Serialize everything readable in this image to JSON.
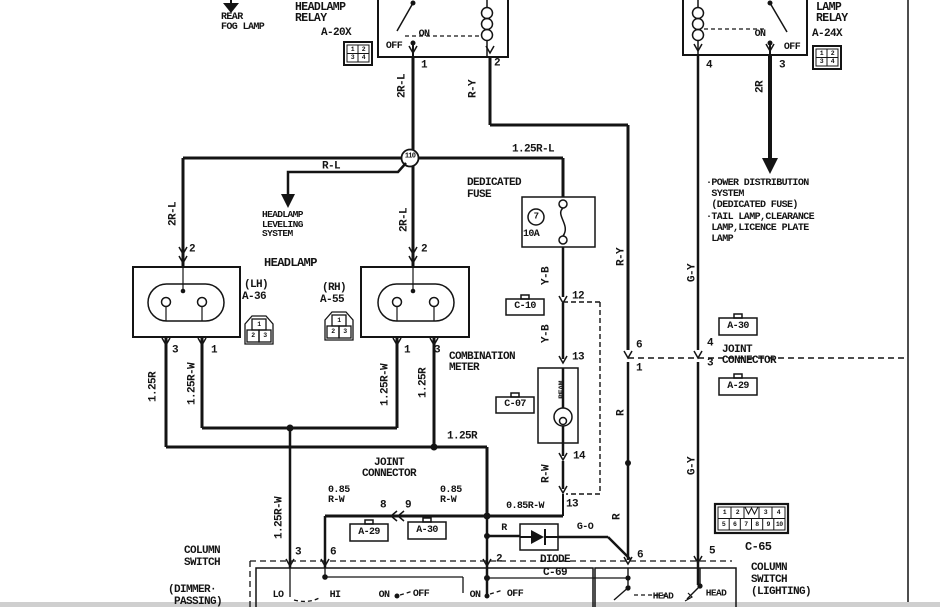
{
  "ink": "#141414",
  "page": {
    "right_border": true,
    "bottom_strip_color": "#cfcfcf"
  },
  "arrows_text": {
    "rear_fog": "REAR\nFOG LAMP",
    "leveling": "HEADLAMP\nLEVELING\nSYSTEM",
    "notes": "·POWER DISTRIBUTION\n SYSTEM\n (DEDICATED FUSE)\n·TAIL LAMP,CLEARANCE\n LAMP,LICENCE PLATE\n LAMP"
  },
  "relays": {
    "headlamp": {
      "name": "HEADLAMP\nRELAY",
      "code": "A-20X",
      "on": "ON",
      "off": "OFF",
      "pin_left": "1",
      "pin_right": "2"
    },
    "tail": {
      "name": "LAMP\nRELAY",
      "code": "A-24X",
      "on": "ON",
      "off": "OFF",
      "pin_left": "4",
      "pin_right": "3"
    }
  },
  "grid_pins": [
    "1",
    "2",
    "3",
    "4"
  ],
  "splice": "110",
  "fuse": {
    "title": "DEDICATED\nFUSE",
    "number": "7",
    "rating": "10A"
  },
  "headlamps": {
    "title": "HEADLAMP",
    "lh": "(LH)",
    "lh_code": "A-36",
    "rh": "(RH)",
    "rh_code": "A-55",
    "lh_top": "2",
    "lh_b1": "3",
    "lh_b2": "1",
    "rh_top": "2",
    "rh_b1": "1",
    "rh_b2": "3",
    "conn_pins": [
      "1",
      "2",
      "3"
    ]
  },
  "meter": {
    "title": "COMBINATION\nMETER",
    "beam": "BEAM",
    "c10": "C-10",
    "c07": "C-07",
    "pin12": "12",
    "pin13": "13",
    "pin14": "14",
    "pin13b": "13"
  },
  "joint_mid": {
    "title": "JOINT\nCONNECTOR",
    "a29": "A-29",
    "a30": "A-30",
    "pin8": "8",
    "pin9": "9",
    "w_left": "0.85\nR-W",
    "w_right": "0.85\nR-W",
    "w_out": "0.85R-W"
  },
  "joint_right": {
    "title": "JOINT\nCONNECTOR",
    "a30": "A-30",
    "a29": "A-29",
    "pin6": "6",
    "pin1": "1",
    "pin4": "4",
    "pin3": "3"
  },
  "diode": {
    "title": "DIODE",
    "code": "C-69",
    "w_in": "R",
    "w_out": "G-O"
  },
  "cs_dimmer": {
    "title": "COLUMN\nSWITCH",
    "subtitle": "(DIMMER·\n PASSING)",
    "pin3": "3",
    "pin6": "6",
    "pin2": "2",
    "lo": "LO",
    "hi": "HI",
    "on1": "ON",
    "off1": "OFF",
    "on2": "ON",
    "off2": "OFF"
  },
  "cs_lighting": {
    "title": "COLUMN\nSWITCH\n(LIGHTING)",
    "code": "C-65",
    "pin6": "6",
    "pin5": "5",
    "head1": "HEAD",
    "head2": "HEAD",
    "pins": [
      "1",
      "2",
      "3",
      "4",
      "5",
      "6",
      "7",
      "8",
      "9",
      "10"
    ]
  },
  "wires": {
    "w2rl": "2R-L",
    "wry": "R-Y",
    "w2r": "2R",
    "wrl": "R-L",
    "w125rl": "1.25R-L",
    "w125r": "1.25R",
    "w125rw": "1.25R-W",
    "wyb": "Y-B",
    "wrw": "R-W",
    "wr": "R",
    "wgy": "G-Y",
    "wgo": "G-O"
  }
}
